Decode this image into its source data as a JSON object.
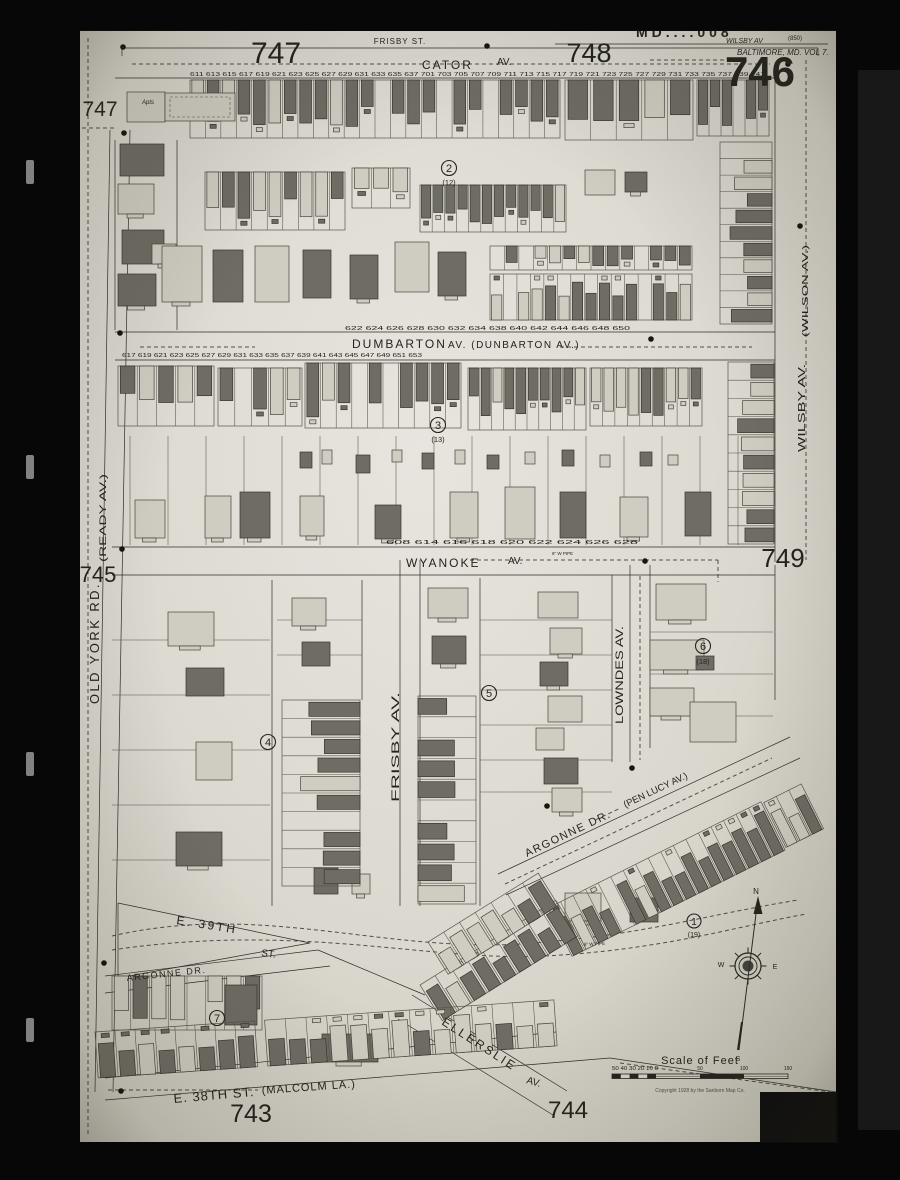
{
  "colors": {
    "background": "#0a0a0a",
    "paper": "#d9d6cc",
    "ink": "#23221d",
    "building_shaded": "#6e6b64",
    "building_frame": "#cfccc2"
  },
  "sheet": {
    "number": "746",
    "stamp": "MD....008",
    "stamp_note": "WILSBY AV",
    "stamp_paren": "(850)",
    "volume": "BALTIMORE, MD. VOL 7."
  },
  "adjacent": {
    "top_left": "747",
    "left_top": "747",
    "top_right": "748",
    "left": "745",
    "right": "749",
    "bottom_left": "743",
    "bottom_center": "744"
  },
  "streets": {
    "frisby_st": "FRISBY ST.",
    "cator": {
      "name": "CATOR",
      "suffix": "AV."
    },
    "dumbarton": {
      "name": "DUMBARTON",
      "suffix": "AV. (DUNBARTON AV.)"
    },
    "wyanoke": {
      "name": "WYANOKE",
      "suffix": "AV."
    },
    "old_york_rd": "OLD YORK RD.",
    "ready": "(READY AV.)",
    "wilson": "(WILSON AV.)",
    "wilsby": "WILSBY AV.",
    "lowndes": "LOWNDES AV.",
    "frisby_av": "FRISBY AV.",
    "argonne": {
      "name": "ARGONNE DR.",
      "paren": "(PEN LUCY AV.)"
    },
    "e39th": {
      "name": "E. 39TH",
      "suffix": "ST."
    },
    "argonne_lower": "ARGONNE DR.",
    "ellerslie": {
      "name": "ELLERSLIE",
      "suffix": "AV."
    },
    "e38th": {
      "name": "E. 38TH ST.",
      "paren": "(MALCOLM LA.)"
    }
  },
  "badges": {
    "b1": {
      "num": "1",
      "sub": "(19)"
    },
    "b2": {
      "num": "2",
      "sub": "(12)"
    },
    "b3": {
      "num": "3",
      "sub": "(13)"
    },
    "b4": {
      "num": "4",
      "sub": ""
    },
    "b5": {
      "num": "5",
      "sub": ""
    },
    "b6": {
      "num": "6",
      "sub": "(18)"
    },
    "b7": {
      "num": "7",
      "sub": ""
    }
  },
  "scale": {
    "title": "Scale of Feet",
    "ticks_left": "50 40 30 20 10 0",
    "tick_50": "50",
    "tick_100": "100",
    "tick_150": "150",
    "copyright": "Copyright 1928 by the Sanborn Map Co."
  },
  "compass": {
    "n": "N",
    "e": "E",
    "w": "W",
    "s": "S"
  },
  "annotations": {
    "apts": "Apts",
    "pipe_a": "6\" W PIPE",
    "pipe_b": "6\" W PIPE"
  },
  "house_numbers": {
    "cator": "611 613 615 617 619 621 623 625 627 629 631 633 635 637 701 703 705 707 709 711 713 715 717 719 721 723 725 727 729 731 733 735 737 739 741",
    "dumbarton_north": "622 624 626 628 630 632 634 638 640 642 644 646 648 650",
    "dumbarton_south": "617 619 621 623 625 627 629 631 633 635 637 639 641 643 645 647 649 651 653",
    "wyanoke": "608 614 616 618 620 622 624 626 628"
  }
}
